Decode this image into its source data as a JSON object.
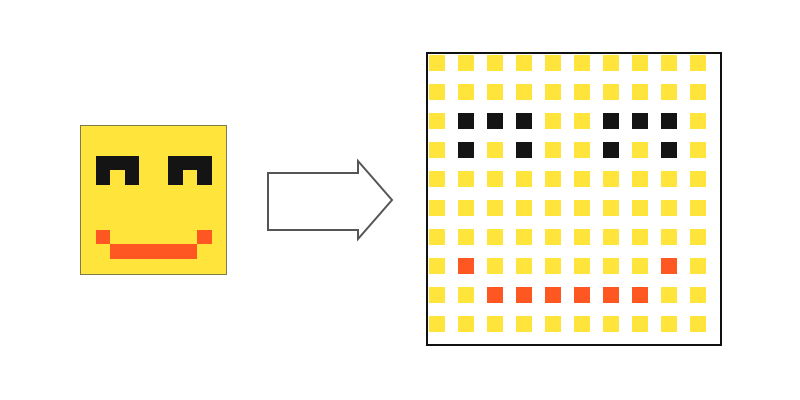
{
  "palette": {
    "Y": "#ffe53b",
    "B": "#141414",
    "O": "#ff5722"
  },
  "pixel_grid": {
    "rows": 10,
    "cols": 10,
    "cells": [
      "YYYYYYYYYY",
      "YYYYYYYYYY",
      "YBBBYYBBBY",
      "YBYBYYBYBY",
      "YYYYYYYYYY",
      "YYYYYYYYYY",
      "YYYYYYYYYY",
      "YOYYYYYYOY",
      "YYOOOOOOYY",
      "YYYYYYYYYY"
    ]
  },
  "colors": {
    "background": "#ffffff",
    "source_border": "#7f7a4e",
    "output_border": "#111111",
    "arrow_stroke": "#555555",
    "arrow_fill": "#ffffff"
  },
  "icons": {
    "arrow": "right-arrow"
  }
}
